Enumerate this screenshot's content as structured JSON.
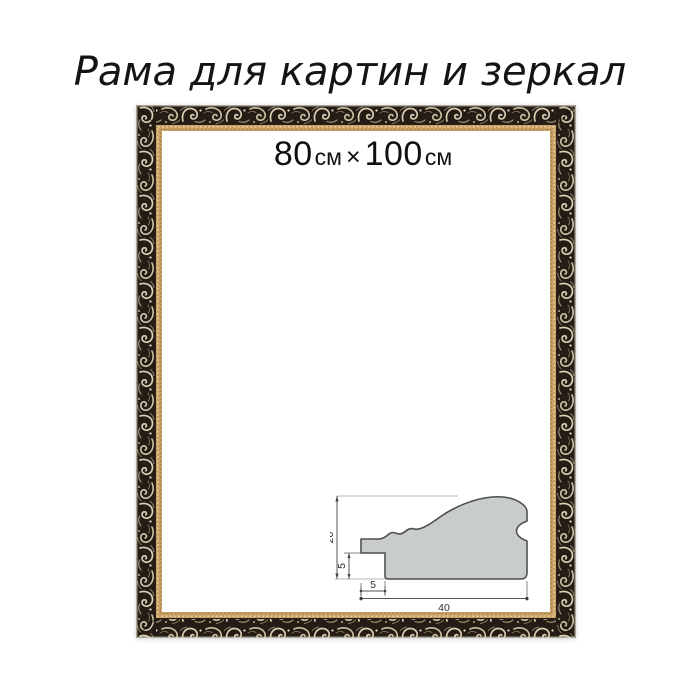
{
  "title": "Рама для картин и зеркал",
  "size_label": {
    "width_value": "80",
    "width_unit": "см",
    "multiply_sign": "×",
    "height_value": "100",
    "height_unit": "см"
  },
  "frame": {
    "type": "ornate baroque picture frame, dark with silver scrollwork and gold inner lip",
    "band_dark": "#241c15",
    "ornament_light": "#d9ceb3",
    "ornament_mid": "#cfc3a6",
    "ornament_shadow": "#9a8d70",
    "outer_highlight": "#d7d0bd",
    "lip_gold": "#c79e63",
    "lip_bead_highlight": "#ecd5a4",
    "lip_bead_shadow": "#8a6336",
    "interior": "#ffffff"
  },
  "profile_diagram": {
    "type": "moulding cross-section technical drawing",
    "shape_fill": "#c9cccd",
    "shape_stroke": "#4f4f4f",
    "dimensions": {
      "total_height": "20",
      "rabbet_height": "5",
      "lip_width": "5",
      "total_width": "40"
    }
  }
}
